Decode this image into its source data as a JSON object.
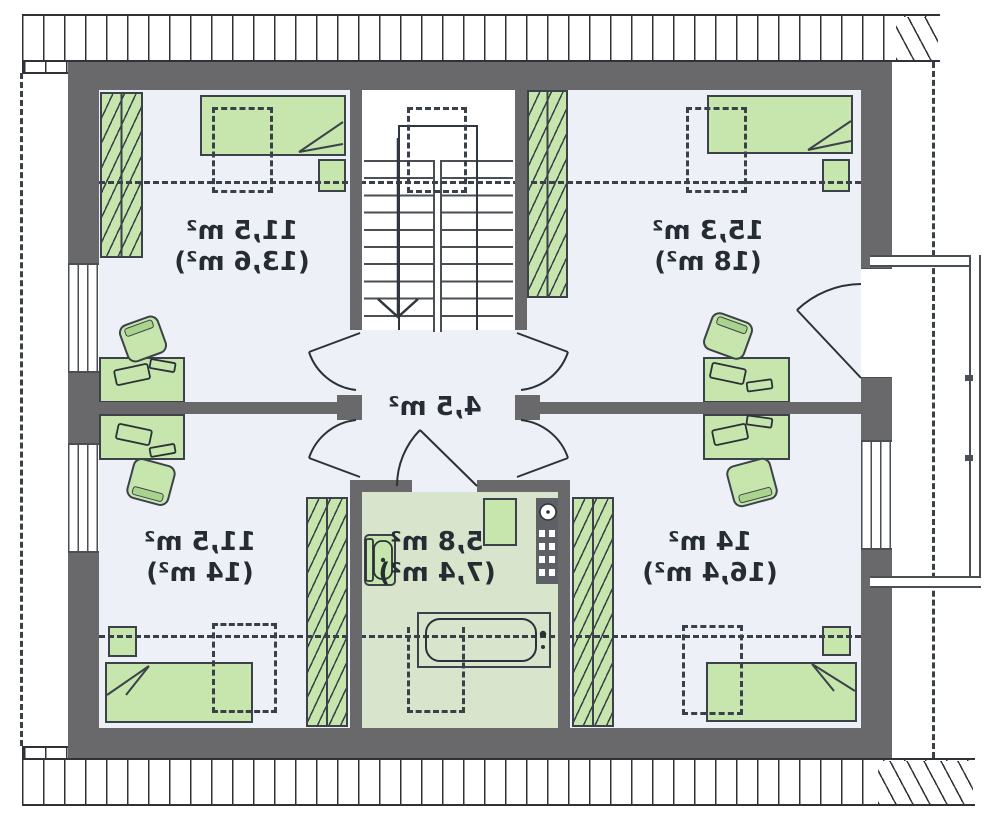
{
  "plan": {
    "type": "attic-floor-plan",
    "units": "m²",
    "rooms": {
      "top_left": {
        "area": "11,5 m²",
        "area_note": "(13,6 m²)"
      },
      "top_right": {
        "area": "15,3 m²",
        "area_note": "(18 m²)"
      },
      "hall": {
        "area": "4,5 m²",
        "area_note": ""
      },
      "bathroom": {
        "area": "5,8 m²",
        "area_note": "(7,4 m²)"
      },
      "bottom_left": {
        "area": "11,5 m²",
        "area_note": "(14 m²)"
      },
      "bottom_right": {
        "area": "14 m²",
        "area_note": "(16,4 m²)"
      }
    },
    "colors": {
      "wall": "#69696b",
      "room_floor": "#edf0f7",
      "bathroom_floor": "#d9e4cd",
      "furniture": "#c6e6ae",
      "outline": "#3b4249"
    }
  }
}
